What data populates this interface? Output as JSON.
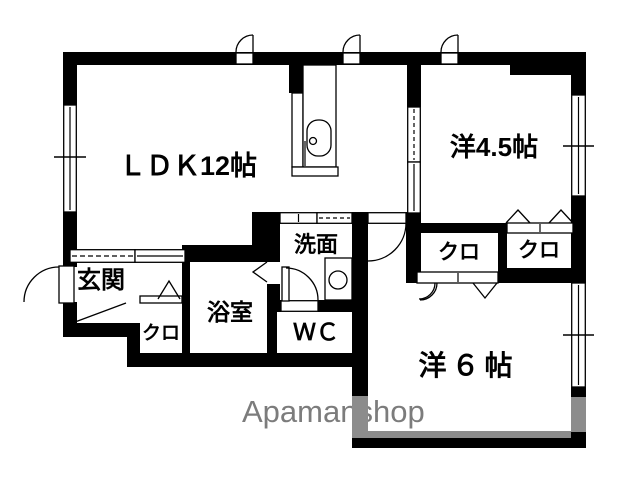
{
  "meta": {
    "type": "apartment-floor-plan"
  },
  "colors": {
    "wall": "#000000",
    "shadow_wall": "#8c8c8c",
    "watermark": "#7c7c7c",
    "background": "#ffffff"
  },
  "rooms": {
    "ldk": {
      "label": "ＬＤＫ12帖"
    },
    "western_room_4_5": {
      "label": "洋4.5帖"
    },
    "western_room_6": {
      "label": "洋６帖"
    },
    "entrance": {
      "label": "玄関"
    },
    "bathroom": {
      "label": "浴室"
    },
    "washroom": {
      "label": "洗面"
    },
    "toilet": {
      "label": "ＷＣ"
    },
    "closet_entrance": {
      "label": "クロ"
    },
    "closet_west6": {
      "label": "クロ"
    },
    "closet_west45": {
      "label": "クロ"
    }
  },
  "watermark": {
    "text": "Apamanshop"
  }
}
